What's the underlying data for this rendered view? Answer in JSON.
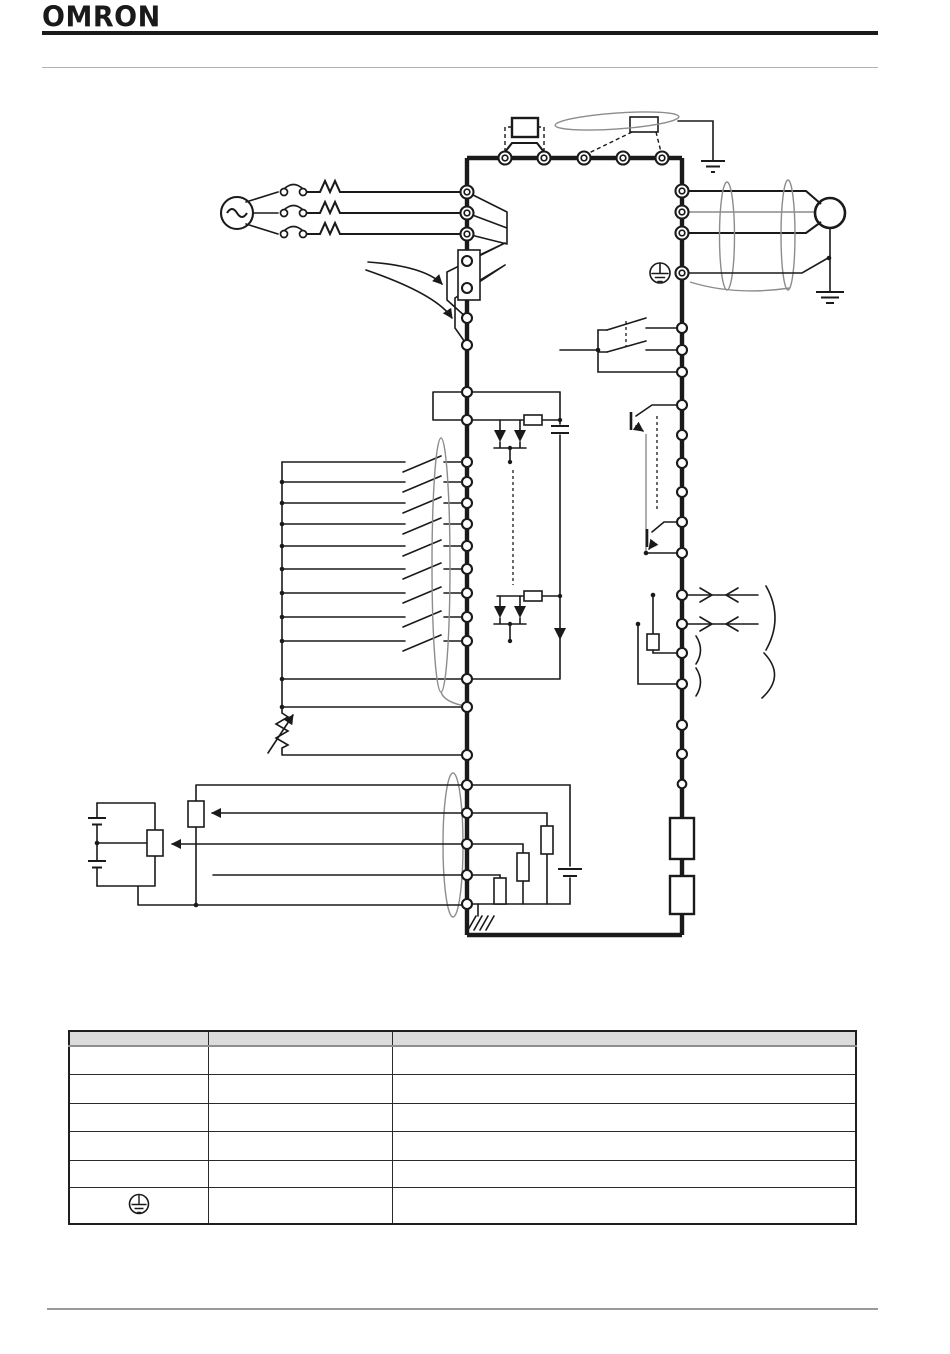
{
  "page": {
    "brand": "OMRON"
  },
  "colors": {
    "ink": "#1a1a1a",
    "gray": "#8c8c8c",
    "light_gray": "#b3b3b3",
    "table_header_bg": "#dcdcdc",
    "table_header_border": "#8f8f8f"
  },
  "diagram": {
    "icons": [
      "three-phase-source-icon",
      "contact-icon",
      "fuse-icon",
      "dc-reactor-icon",
      "braking-resistor-icon",
      "shield-cable-icon",
      "motor-icon",
      "ground-icon",
      "protective-earth-icon",
      "potentiometer-icon",
      "optocoupler-icon",
      "relay-contact-icon",
      "transistor-icon",
      "termination-resistor-icon",
      "analog-meter-icon",
      "battery-icon",
      "chassis-ground-icon"
    ]
  },
  "table": {
    "columns": [
      "",
      "",
      ""
    ],
    "rows": [
      [
        "",
        "",
        ""
      ],
      [
        "",
        "",
        ""
      ],
      [
        "",
        "",
        ""
      ],
      [
        "",
        "",
        ""
      ],
      [
        "",
        "",
        ""
      ],
      [
        "",
        "",
        ""
      ]
    ],
    "pe_symbol": "protective-earth-icon"
  }
}
